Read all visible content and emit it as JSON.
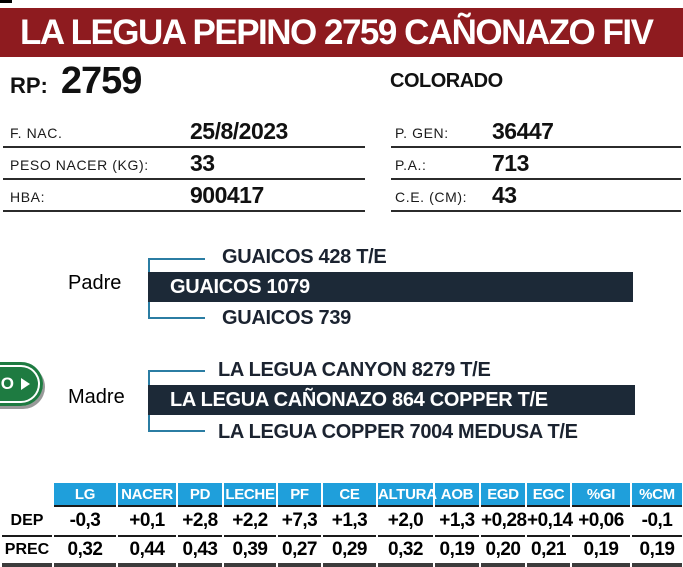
{
  "header": {
    "title": "LA LEGUA PEPINO 2759 CAÑONAZO FIV",
    "banner_color": "#8E1B1F"
  },
  "subheader": {
    "rp_label": "RP:",
    "rp_value": "2759",
    "color": "COLORADO"
  },
  "info": {
    "left": [
      {
        "label": "F. NAC.",
        "value": "25/8/2023"
      },
      {
        "label": "PESO NACER (KG):",
        "value": "33"
      },
      {
        "label": "HBA:",
        "value": "900417"
      }
    ],
    "right": [
      {
        "label": "P. GEN:",
        "value": "36447"
      },
      {
        "label": "P.A.:",
        "value": "713"
      },
      {
        "label": "C.E. (CM):",
        "value": "43"
      }
    ]
  },
  "video_button": {
    "visible_label": "O",
    "play_icon": "play-triangle",
    "color": "#1E7B41"
  },
  "pedigree": {
    "bar_color": "#1C2937",
    "bracket_color": "#2B7DA3",
    "padre": {
      "label": "Padre",
      "sire": "GUAICOS 428 T/E",
      "name": "GUAICOS 1079",
      "dam": "GUAICOS 739"
    },
    "madre": {
      "label": "Madre",
      "sire": "LA LEGUA CANYON 8279 T/E",
      "name": "LA LEGUA CAÑONAZO 864 COPPER T/E",
      "dam": "LA LEGUA COPPER 7004 MEDUSA T/E"
    }
  },
  "epd_table": {
    "header_color": "#1F9FDB",
    "columns": [
      "LG",
      "NACER",
      "PD",
      "LECHE",
      "PF",
      "CE",
      "ALTURA",
      "AOB",
      "EGD",
      "EGC",
      "%GI",
      "%CM"
    ],
    "rows": [
      {
        "label": "DEP",
        "values": [
          "-0,3",
          "+0,1",
          "+2,8",
          "+2,2",
          "+7,3",
          "+1,3",
          "+2,0",
          "+1,3",
          "+0,28",
          "+0,14",
          "+0,06",
          "-0,1"
        ]
      },
      {
        "label": "PREC",
        "values": [
          "0,32",
          "0,44",
          "0,43",
          "0,39",
          "0,27",
          "0,29",
          "0,32",
          "0,19",
          "0,20",
          "0,21",
          "0,19",
          "0,19"
        ]
      }
    ]
  }
}
